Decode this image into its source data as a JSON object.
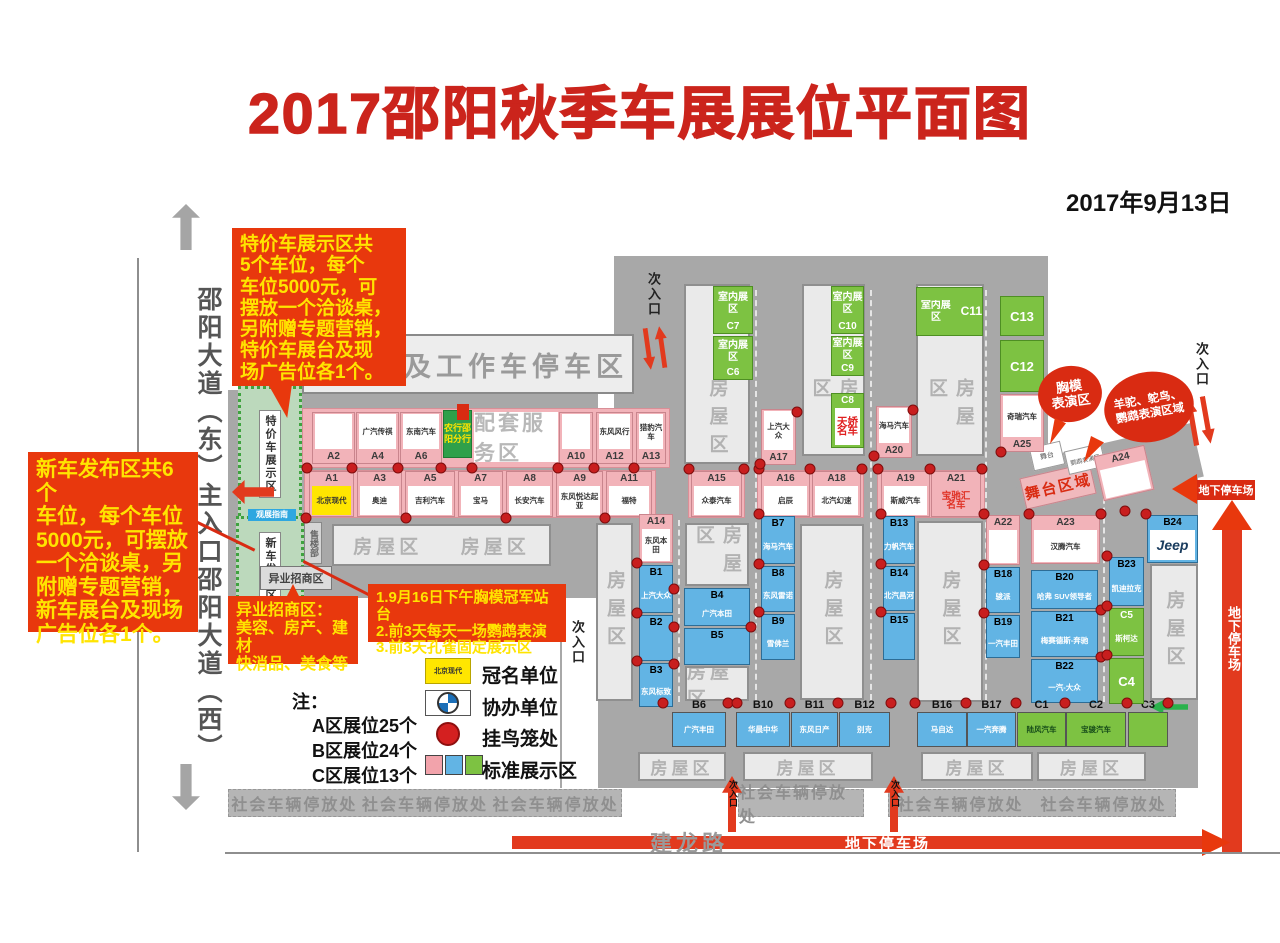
{
  "palette": {
    "title_red": "#cb241c",
    "annotation_red": "#e8380d",
    "annotation_yellow": "#ffe400",
    "map_gray": "#a8a8a8",
    "booth_pink": "#f2b3b9",
    "booth_blue": "#62b4e4",
    "booth_green": "#7dc242",
    "sponsor_yellow": "#ffe600"
  },
  "header": {
    "title": "2017邵阳秋季车展展位平面图",
    "date": "2017年9月13日"
  },
  "roads": {
    "street_vertical": "邵阳大道（东）主入口邵阳大道（西）",
    "jianlong_road": "建龙路"
  },
  "areas": {
    "test_drive": "试驾车及工作车停车区",
    "service": "配套服务区",
    "bank": "农行邵阳分行",
    "housing": "房屋区",
    "public_parking": "社会车辆停放处",
    "underground_parking": "地下停车场",
    "sub_entrance": "次入口",
    "special_car_zone": "特价车展示区",
    "new_car_zone": "新车发布区",
    "cross_industry_zone": "异业招商区",
    "sales_office": "售楼部",
    "guide": "观展指南",
    "stage_zone": "舞台区域",
    "stage": "舞台",
    "parrot_zone": "鹦鹉表演区",
    "indoor": "室内展区"
  },
  "annotations": {
    "special_car": "特价车展示区共\n5个车位，每个\n车位5000元，可\n摆放一个洽谈桌，\n另附赠专题营销，\n特价车展台及现\n场广告位各1个。",
    "new_car": "新车发布区共6个\n车位，每个车位\n5000元，可摆放\n一个洽谈桌，另\n附赠专题营销，\n新车展台及现场\n广告位各1个。",
    "cross_industry": "异业招商区：\n美容、房产、建材\n快消品、美食等",
    "events": "1.9月16日下午胸模冠军站台\n2.前3天每天一场鹦鹉表演\n3.前3天孔雀固定展示区",
    "bubble_model": "胸模\n表演区",
    "bubble_animal": "羊驼、鸵鸟、\n鹦鹉表演区域"
  },
  "legend": {
    "note_title": "注：",
    "notes": [
      "A区展位25个",
      "B区展位24个",
      "C区展位13个",
      "共计展位62个"
    ],
    "title_sponsor_text": "北京现代",
    "items": [
      {
        "label": "冠名单位"
      },
      {
        "label": "协办单位"
      },
      {
        "label": "挂鸟笼处"
      },
      {
        "label": "标准展示区"
      }
    ]
  },
  "booths": [
    {
      "id": "A1",
      "brand": "北京现代"
    },
    {
      "id": "A2",
      "brand": ""
    },
    {
      "id": "A3",
      "brand": "奥迪"
    },
    {
      "id": "A4",
      "brand": "广汽传祺"
    },
    {
      "id": "A5",
      "brand": "吉利汽车"
    },
    {
      "id": "A6",
      "brand": "东南汽车"
    },
    {
      "id": "A7",
      "brand": "宝马"
    },
    {
      "id": "A8",
      "brand": "长安汽车"
    },
    {
      "id": "A9",
      "brand": "东风悦达起亚"
    },
    {
      "id": "A10",
      "brand": ""
    },
    {
      "id": "A11",
      "brand": "福特"
    },
    {
      "id": "A12",
      "brand": "东风风行"
    },
    {
      "id": "A13",
      "brand": "猎豹汽车"
    },
    {
      "id": "A14",
      "brand": "东风本田"
    },
    {
      "id": "A15",
      "brand": "众泰汽车"
    },
    {
      "id": "A16",
      "brand": "启辰"
    },
    {
      "id": "A17",
      "brand": "上汽大众"
    },
    {
      "id": "A18",
      "brand": "北汽幻速"
    },
    {
      "id": "A19",
      "brand": "斯威汽车"
    },
    {
      "id": "A20",
      "brand": "海马汽车"
    },
    {
      "id": "A21",
      "brand": "宝驰汇\n名车"
    },
    {
      "id": "A22",
      "brand": ""
    },
    {
      "id": "A23",
      "brand": "汉腾汽车"
    },
    {
      "id": "A24",
      "brand": ""
    },
    {
      "id": "A25",
      "brand": "奇瑞汽车"
    },
    {
      "id": "B1",
      "brand": "上汽大众"
    },
    {
      "id": "B2",
      "brand": ""
    },
    {
      "id": "B3",
      "brand": "东风标致"
    },
    {
      "id": "B4",
      "brand": "广汽本田"
    },
    {
      "id": "B5",
      "brand": ""
    },
    {
      "id": "B6",
      "brand": "广汽丰田"
    },
    {
      "id": "B7",
      "brand": "海马汽车"
    },
    {
      "id": "B8",
      "brand": "东风雷诺"
    },
    {
      "id": "B9",
      "brand": "雪佛兰"
    },
    {
      "id": "B10",
      "brand": "华晨中华"
    },
    {
      "id": "B11",
      "brand": "东风日产"
    },
    {
      "id": "B12",
      "brand": "别克"
    },
    {
      "id": "B13",
      "brand": "力帆汽车"
    },
    {
      "id": "B14",
      "brand": "北汽昌河"
    },
    {
      "id": "B15",
      "brand": ""
    },
    {
      "id": "B16",
      "brand": "马自达"
    },
    {
      "id": "B17",
      "brand": "一汽奔腾"
    },
    {
      "id": "B18",
      "brand": "骏派"
    },
    {
      "id": "B19",
      "brand": "一汽丰田"
    },
    {
      "id": "B20",
      "brand": "哈弗 SUV领导者"
    },
    {
      "id": "B21",
      "brand": "梅赛德斯-奔驰"
    },
    {
      "id": "B22",
      "brand": "一汽-大众"
    },
    {
      "id": "B23",
      "brand": "凯迪拉克"
    },
    {
      "id": "B24",
      "brand": "Jeep"
    },
    {
      "id": "C1",
      "brand": "陆风汽车"
    },
    {
      "id": "C2",
      "brand": "宝骏汽车"
    },
    {
      "id": "C3",
      "brand": ""
    },
    {
      "id": "C4",
      "brand": ""
    },
    {
      "id": "C5",
      "brand": "斯柯达"
    },
    {
      "id": "C6",
      "brand": "室内展区"
    },
    {
      "id": "C7",
      "brand": "室内展区"
    },
    {
      "id": "C8",
      "brand": "天娇\n名车"
    },
    {
      "id": "C9",
      "brand": "室内展区"
    },
    {
      "id": "C10",
      "brand": "室内展区"
    },
    {
      "id": "C11",
      "brand": "室内展区"
    },
    {
      "id": "C12",
      "brand": ""
    },
    {
      "id": "C13",
      "brand": ""
    }
  ]
}
